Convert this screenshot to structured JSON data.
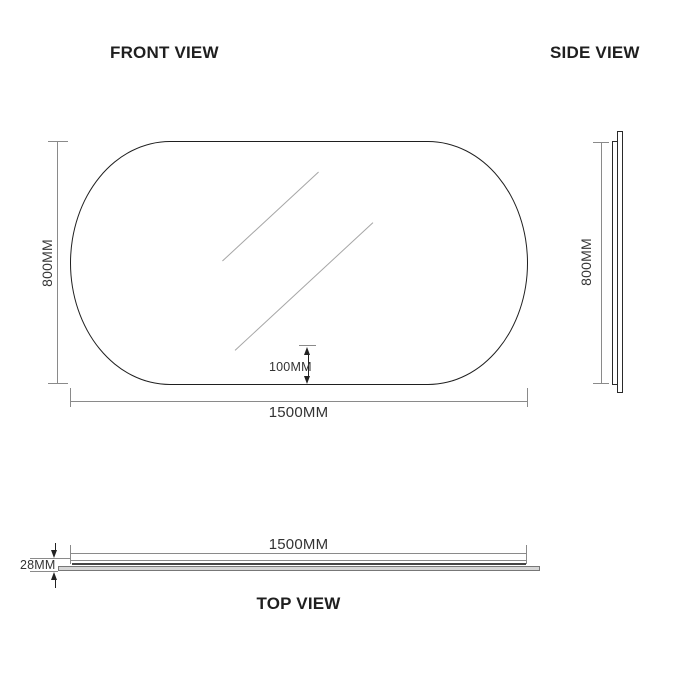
{
  "views": {
    "front": {
      "title": "FRONT VIEW",
      "height_label": "800MM",
      "width_label": "1500MM",
      "bottom_offset_label": "100MM"
    },
    "side": {
      "title": "SIDE VIEW",
      "height_label": "800MM"
    },
    "top": {
      "title": "TOP VIEW",
      "width_label": "1500MM",
      "thickness_label": "28MM"
    }
  },
  "colors": {
    "dimension_line": "#8a8a8a",
    "outline": "#1f1f1f",
    "text": "#333333",
    "title": "#1f1f1f",
    "glass_fill": "#d6d6d6",
    "arrow": "#222222",
    "background": "#ffffff"
  }
}
